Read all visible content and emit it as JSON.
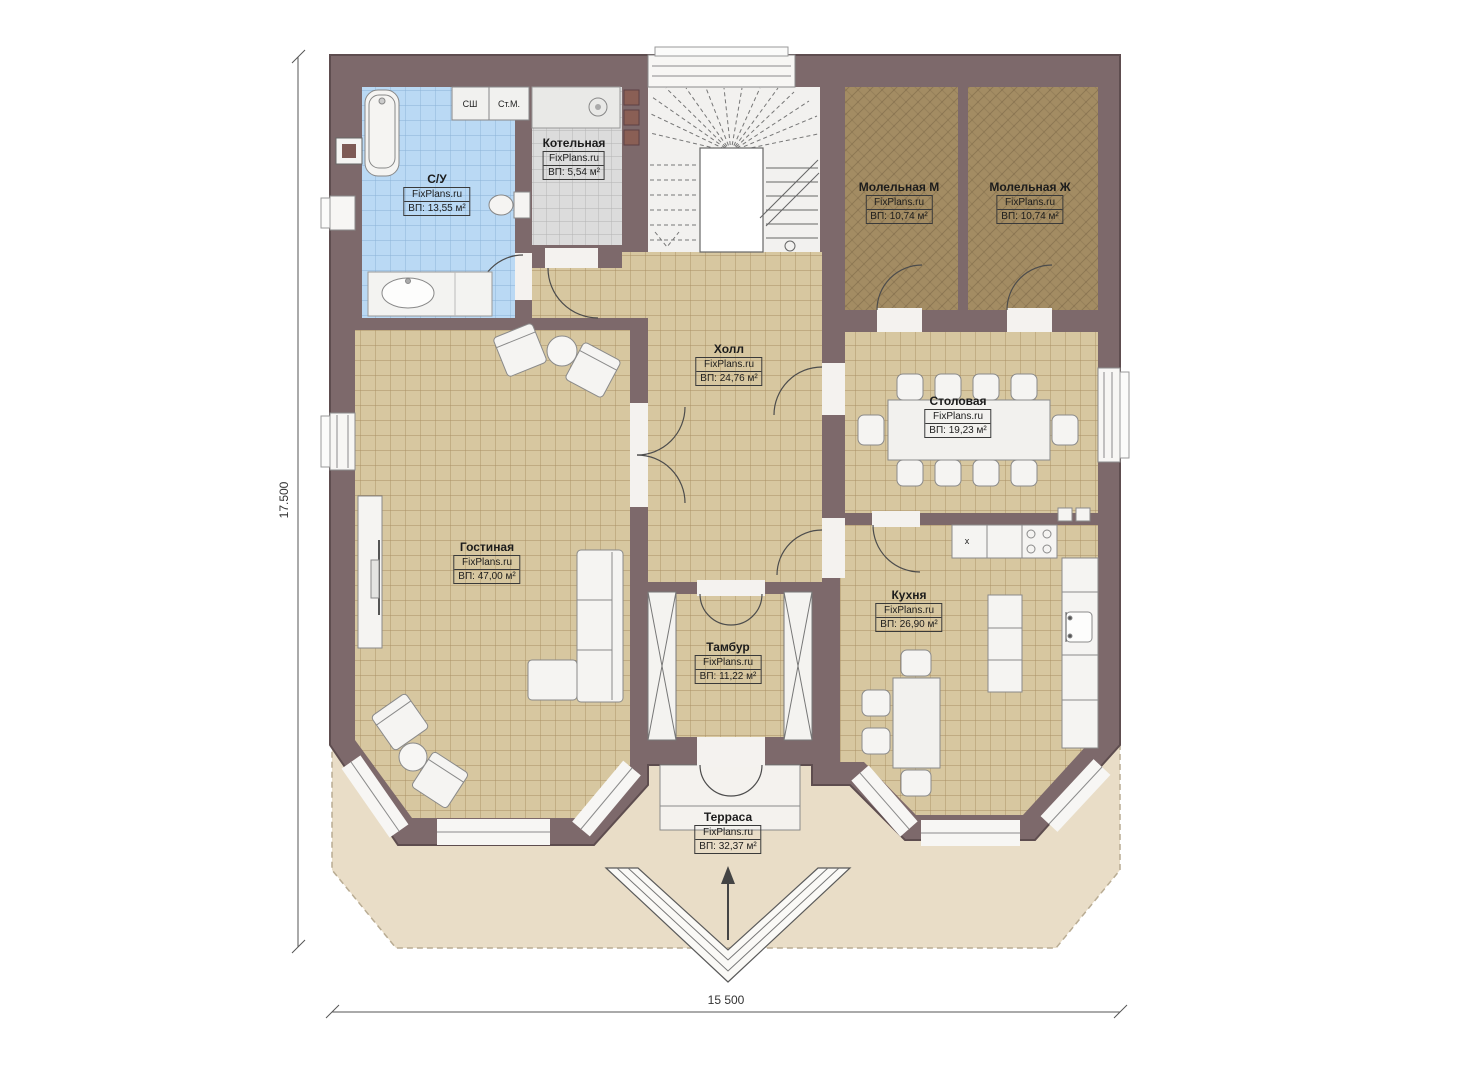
{
  "plan": {
    "type": "floor-plan",
    "dimensions": {
      "height_label": "17.500",
      "width_label": "15 500"
    },
    "colors": {
      "wall": "#7d696b",
      "floor_tile": "#d7c7a0",
      "bath_tile": "#bad9f4",
      "boiler_tile": "#dcdcdc",
      "prayer_carpet": "#a38c63",
      "terrace": "#e9ddc7",
      "fixture": "#f5f4f2"
    }
  },
  "rooms": [
    {
      "id": "su",
      "name": "С/У",
      "brand": "FixPlans.ru",
      "area": "ВП: 13,55 м²"
    },
    {
      "id": "kotelnaya",
      "name": "Котельная",
      "brand": "FixPlans.ru",
      "area": "ВП: 5,54 м²"
    },
    {
      "id": "molelnaya_m",
      "name": "Молельная М",
      "brand": "FixPlans.ru",
      "area": "ВП: 10,74 м²"
    },
    {
      "id": "molelnaya_zh",
      "name": "Молельная Ж",
      "brand": "FixPlans.ru",
      "area": "ВП: 10,74 м²"
    },
    {
      "id": "holl",
      "name": "Холл",
      "brand": "FixPlans.ru",
      "area": "ВП: 24,76 м²"
    },
    {
      "id": "stolovaya",
      "name": "Столовая",
      "brand": "FixPlans.ru",
      "area": "ВП: 19,23 м²"
    },
    {
      "id": "gostinaya",
      "name": "Гостиная",
      "brand": "FixPlans.ru",
      "area": "ВП: 47,00 м²"
    },
    {
      "id": "tambur",
      "name": "Тамбур",
      "brand": "FixPlans.ru",
      "area": "ВП: 11,22 м²"
    },
    {
      "id": "kuhnya",
      "name": "Кухня",
      "brand": "FixPlans.ru",
      "area": "ВП: 26,90 м²"
    },
    {
      "id": "terrasa",
      "name": "Терраса",
      "brand": "FixPlans.ru",
      "area": "ВП: 32,37 м²"
    }
  ],
  "fixtures": {
    "cabinet_1": "СШ",
    "cabinet_2": "Ст.М.",
    "sink_mark": "х"
  }
}
